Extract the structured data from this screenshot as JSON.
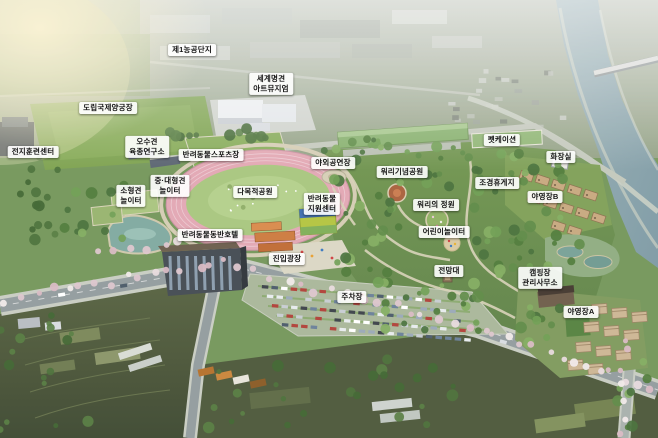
{
  "view": {
    "type": "aerial-masterplan-rendering",
    "subject": "pet theme park site plan bird's-eye view"
  },
  "colors": {
    "track_ring": "#e2a7b3",
    "track_infield": "#a8c67e",
    "river": "#8ba6ae",
    "park_canopy": "#6e9350",
    "label_background": "#ffffff",
    "label_text": "#141414"
  },
  "labels": [
    {
      "id": "agro-industrial-complex-1",
      "text": "제1농공단지",
      "x": 192,
      "y": 50
    },
    {
      "id": "world-dog-art-museum",
      "text": "세계명견\n아트뮤지엄",
      "x": 271,
      "y": 84
    },
    {
      "id": "provincial-intl-archery-field",
      "text": "도립국제양궁장",
      "x": 108,
      "y": 108
    },
    {
      "id": "training-camp-center",
      "text": "전지훈련센터",
      "x": 33,
      "y": 152
    },
    {
      "id": "osu-dog-breeding-institute",
      "text": "오수견\n육종연구소",
      "x": 147,
      "y": 147
    },
    {
      "id": "pet-sports-field",
      "text": "반려동물스포츠장",
      "x": 211,
      "y": 155
    },
    {
      "id": "mid-large-dog-playground",
      "text": "중·대형견\n놀이터",
      "x": 170,
      "y": 186
    },
    {
      "id": "small-dog-playground",
      "text": "소형견\n놀이터",
      "x": 131,
      "y": 196
    },
    {
      "id": "multipurpose-park",
      "text": "다목적공원",
      "x": 255,
      "y": 192
    },
    {
      "id": "outdoor-stage",
      "text": "야외공연장",
      "x": 333,
      "y": 163
    },
    {
      "id": "worri-memorial-park",
      "text": "워리기념공원",
      "x": 402,
      "y": 172
    },
    {
      "id": "petcation",
      "text": "펫케이션",
      "x": 502,
      "y": 140
    },
    {
      "id": "restroom",
      "text": "화장실",
      "x": 561,
      "y": 157
    },
    {
      "id": "landscape-rest-area",
      "text": "조경휴게지",
      "x": 497,
      "y": 183
    },
    {
      "id": "campsite-b",
      "text": "야영장B",
      "x": 545,
      "y": 197
    },
    {
      "id": "worri-garden",
      "text": "워리의 정원",
      "x": 436,
      "y": 205
    },
    {
      "id": "pet-support-center",
      "text": "반려동물\n지원센터",
      "x": 322,
      "y": 204
    },
    {
      "id": "children-playground",
      "text": "어린이놀이터",
      "x": 444,
      "y": 232
    },
    {
      "id": "pet-friendly-hotel",
      "text": "반려동물동반호텔",
      "x": 210,
      "y": 235
    },
    {
      "id": "entrance-plaza",
      "text": "진입광장",
      "x": 287,
      "y": 259
    },
    {
      "id": "observatory",
      "text": "전망대",
      "x": 449,
      "y": 271
    },
    {
      "id": "parking-lot",
      "text": "주차장",
      "x": 352,
      "y": 297
    },
    {
      "id": "campground-office",
      "text": "캠핑장\n관리사무소",
      "x": 540,
      "y": 278
    },
    {
      "id": "campsite-a",
      "text": "야영장A",
      "x": 581,
      "y": 312
    }
  ]
}
